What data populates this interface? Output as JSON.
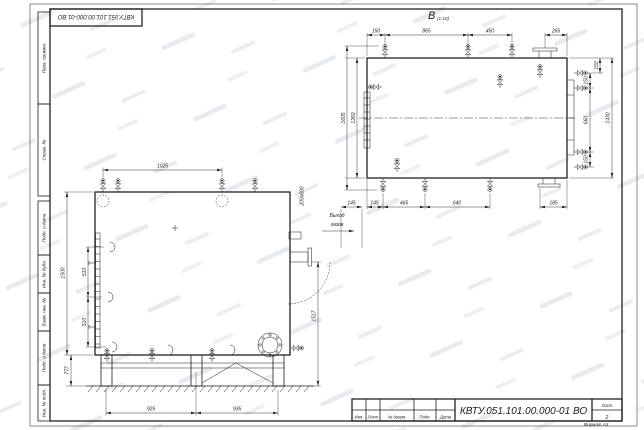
{
  "sheet": {
    "stamp_top": "КВТУ.051.101.00.000-01 ВО",
    "margin_cells": [
      "Перв. примен.",
      "Справ. №",
      "Подп. и дата",
      "Инв. № дубл.",
      "Взам. инв. №",
      "Подп. и дата",
      "Инв. № подл."
    ],
    "format_note": "Формат  А3"
  },
  "title_block": {
    "designation": "КВТУ.051.101.00.000-01 ВО",
    "col_izm": "Изм.",
    "col_list": "Лист",
    "col_doc": "№ докум.",
    "col_sign": "Подп.",
    "col_date": "Дата",
    "sheet_label": "Лист",
    "sheet_number": "2"
  },
  "front_view": {
    "dim_top": "1025",
    "dim_height": "1500",
    "dim_port_pitch_1": "510",
    "dim_port_pitch_2": "510",
    "dim_support": "777",
    "dim_base_left": "925",
    "dim_base_right": "935",
    "outlet_size": "200х600",
    "dim_outlet": "145",
    "dim_outlet_height": "1517",
    "note_line1": "Выход",
    "note_line2": "газов"
  },
  "top_view": {
    "label": "В",
    "label_scale": "(1:10)",
    "dim_top": [
      "150",
      "865",
      "450",
      "265"
    ],
    "dim_right_top": "150",
    "dim_right": [
      "150",
      "660",
      "150"
    ],
    "dim_right_overall": "1430",
    "dim_left_overall": "1605",
    "dim_left": "1260",
    "dim_bottom": [
      "145",
      "465",
      "640",
      "185"
    ]
  }
}
